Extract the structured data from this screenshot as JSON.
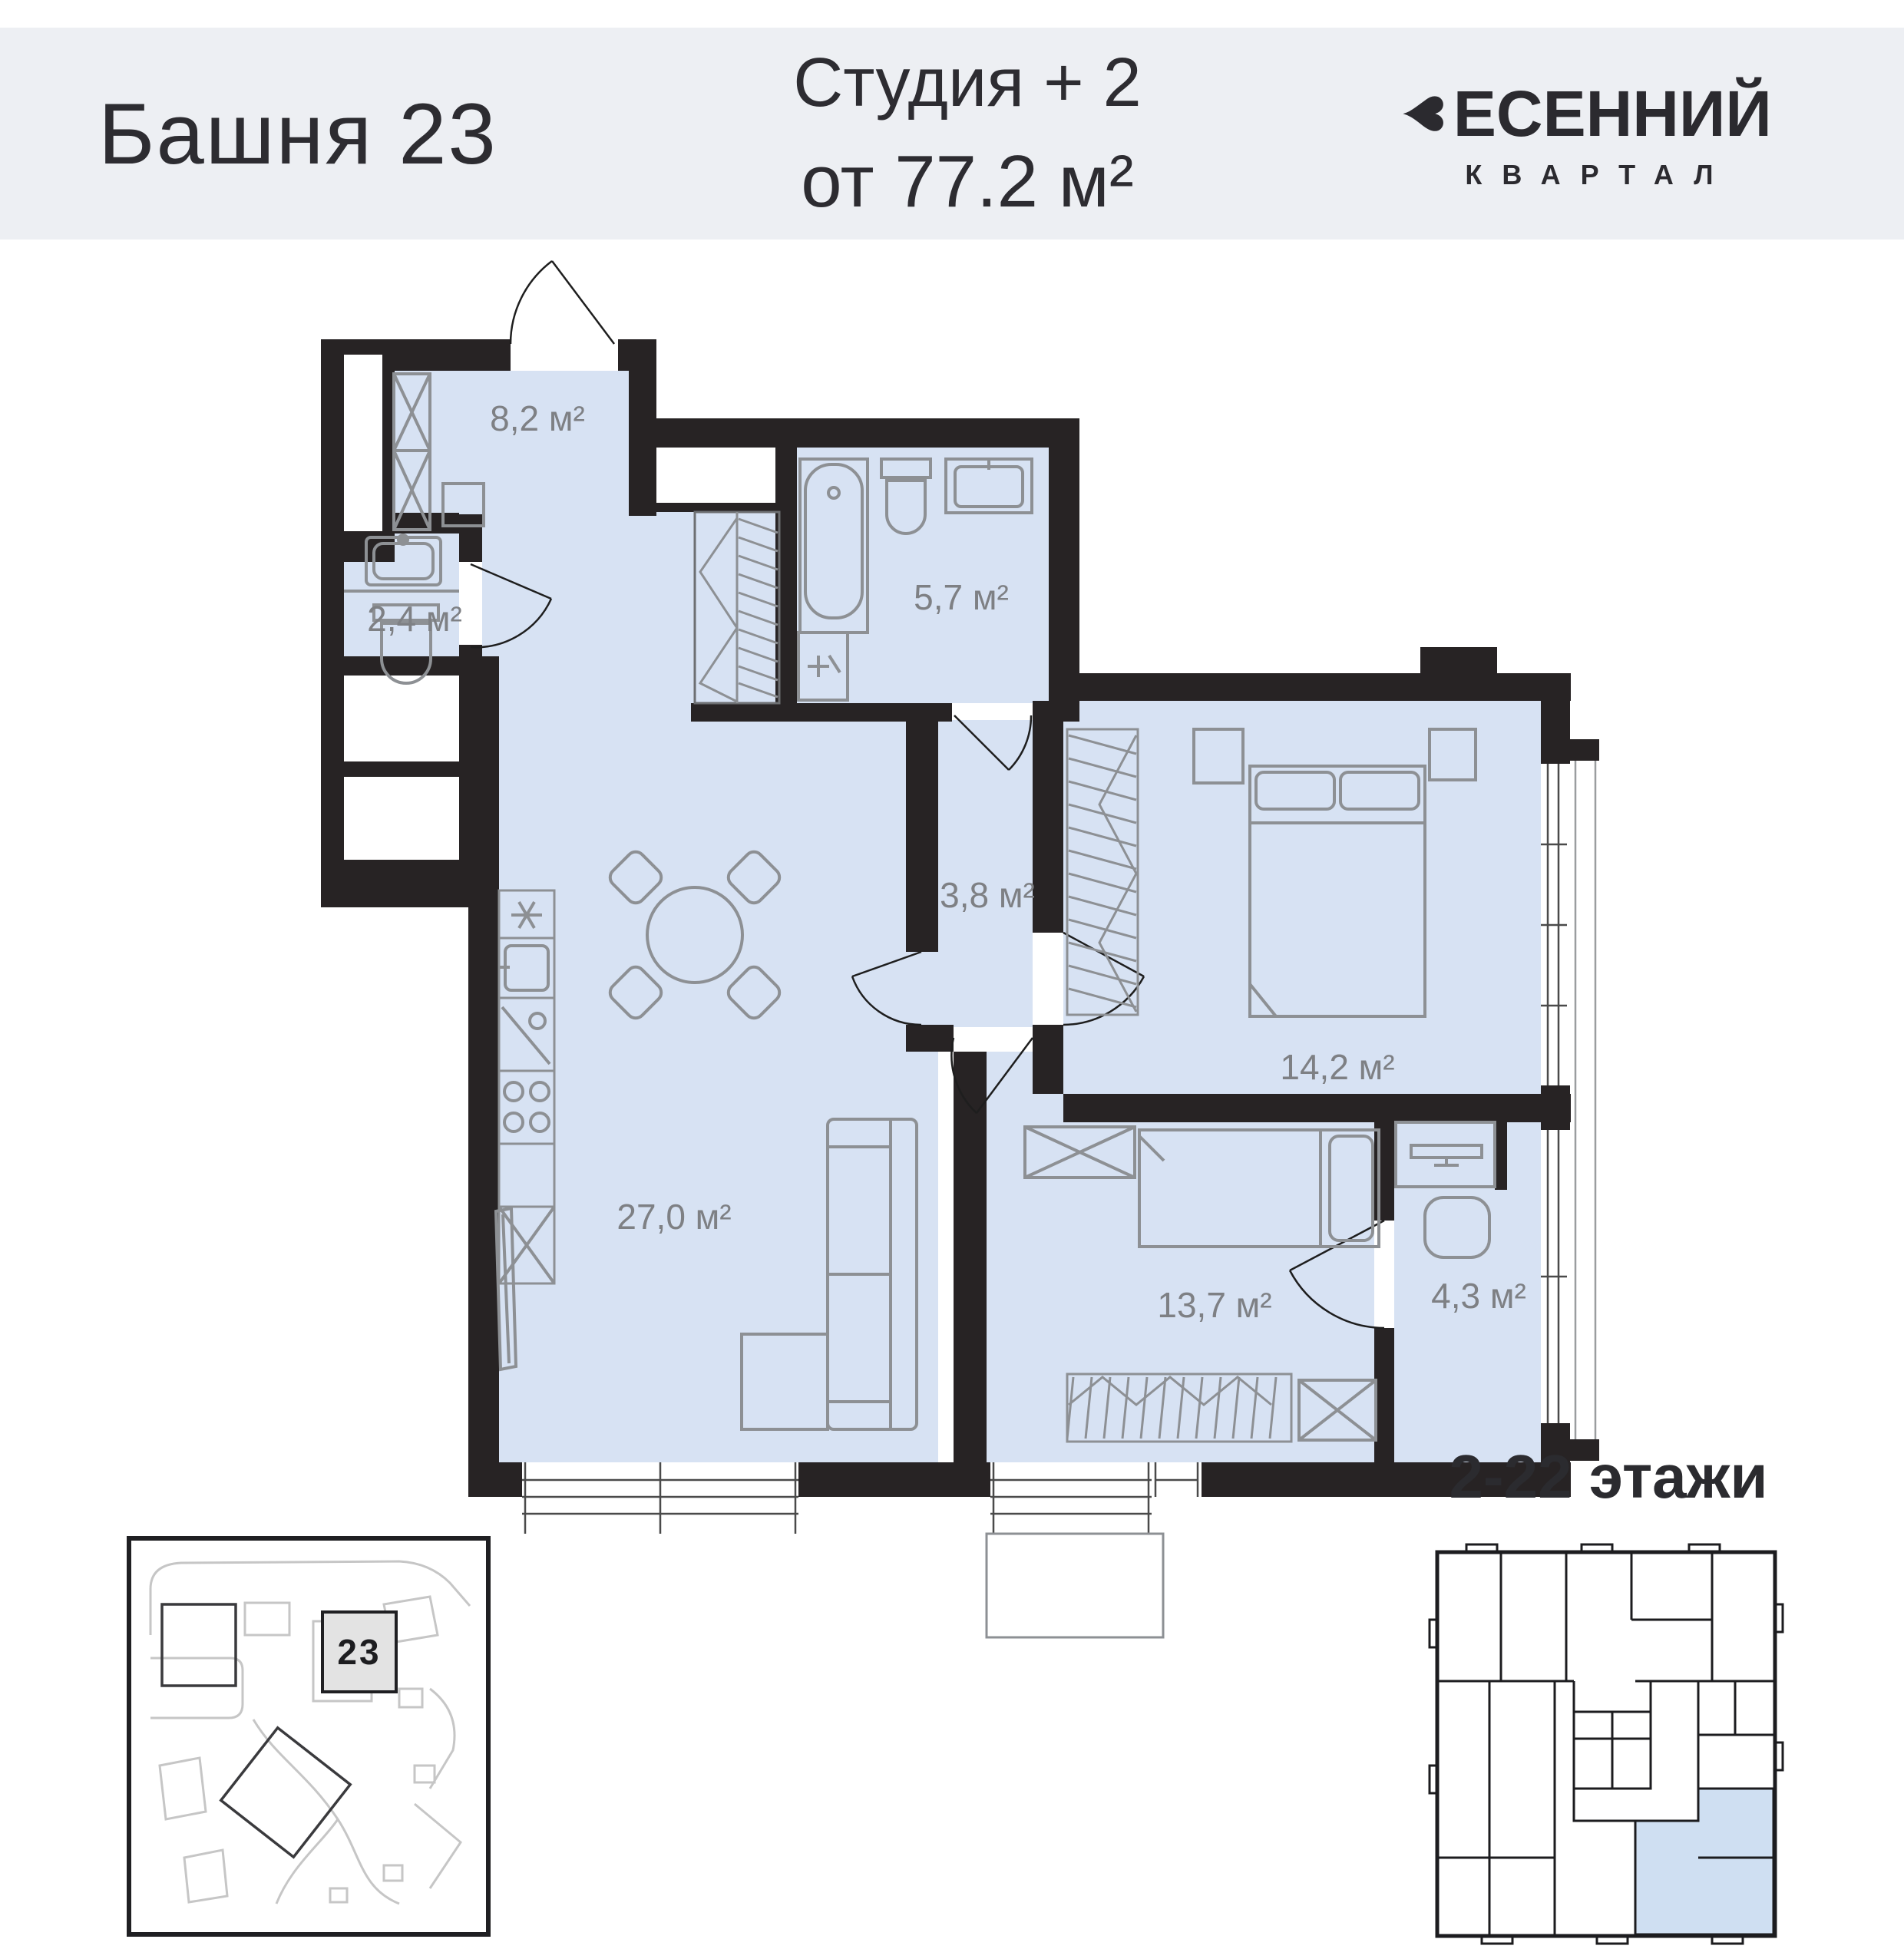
{
  "header": {
    "tower": "Башня 23",
    "type_line": "Студия + 2",
    "area_line": "от 77.2 м²",
    "brand_top": "ЕСЕННИЙ",
    "brand_heart": "♥",
    "brand_bottom": "КВАРТАЛ"
  },
  "plan": {
    "rooms": [
      {
        "name": "hallway",
        "area_label": "8,2 м²"
      },
      {
        "name": "wc",
        "area_label": "2,4 м²"
      },
      {
        "name": "bathroom",
        "area_label": "5,7 м²"
      },
      {
        "name": "corridor",
        "area_label": "3,8 м²"
      },
      {
        "name": "bedroom",
        "area_label": "14,2 м²"
      },
      {
        "name": "living-kitchen",
        "area_label": "27,0 м²"
      },
      {
        "name": "bedroom-2",
        "area_label": "13,7 м²"
      },
      {
        "name": "study",
        "area_label": "4,3 м²"
      }
    ]
  },
  "site_plan": {
    "building_number": "23"
  },
  "key_plan": {
    "floors_label": "2-22 этажи"
  },
  "colors": {
    "band": "#edeff3",
    "text_dark": "#2d2c31",
    "room_fill": "#d7e2f3",
    "wall": "#272324",
    "furniture": "#8d9094",
    "room_label": "#7e8084",
    "key_highlight": "#cfdff2"
  }
}
